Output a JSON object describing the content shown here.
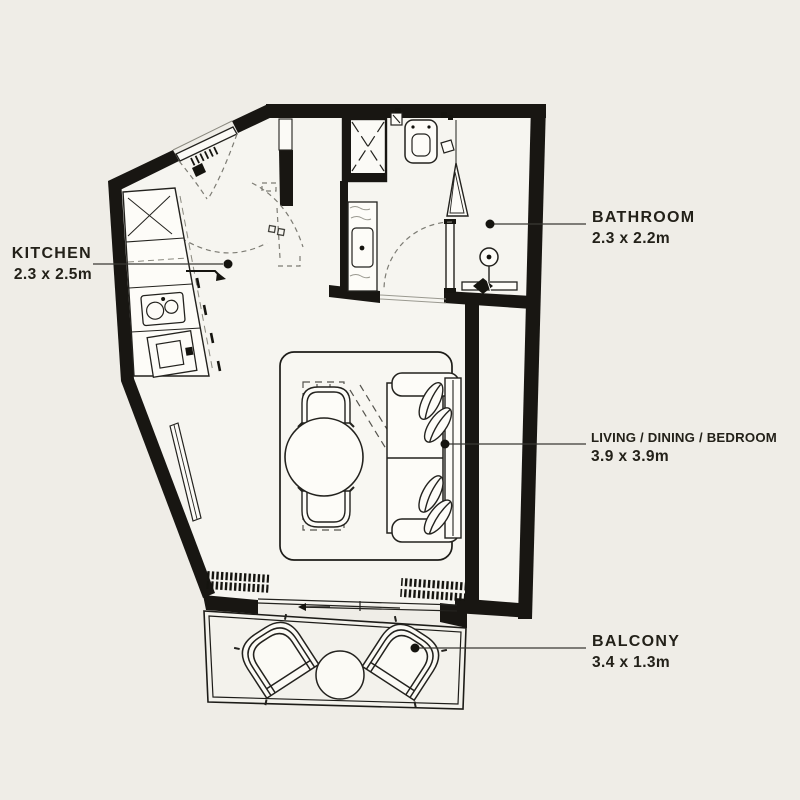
{
  "plan": {
    "type": "apartment-floorplan",
    "colors": {
      "background": "#efede7",
      "floor": "#f6f5f0",
      "wall": "#181612",
      "line": "#23221e",
      "dashed": "#7d7c74",
      "label_text": "#232119"
    },
    "rooms": [
      {
        "id": "kitchen",
        "name": "KITCHEN",
        "dims": "2.3 x 2.5m"
      },
      {
        "id": "bathroom",
        "name": "BATHROOM",
        "dims": "2.3 x 2.2m"
      },
      {
        "id": "living",
        "name": "LIVING / DINING / BEDROOM",
        "dims": "3.9 x 3.9m"
      },
      {
        "id": "balcony",
        "name": "BALCONY",
        "dims": "3.4 x 1.3m"
      }
    ],
    "fixtures": [
      "entry-door",
      "duct-shaft",
      "toilet",
      "vanity-sink",
      "shower-enclosure",
      "shower-head",
      "towel-rail",
      "bathroom-door",
      "kitchen-counter",
      "kitchen-sink",
      "kitchen-oven",
      "dining-table",
      "dining-chairs",
      "sofa-bed",
      "rug",
      "sliding-window",
      "balcony-chairs",
      "balcony-table"
    ]
  }
}
